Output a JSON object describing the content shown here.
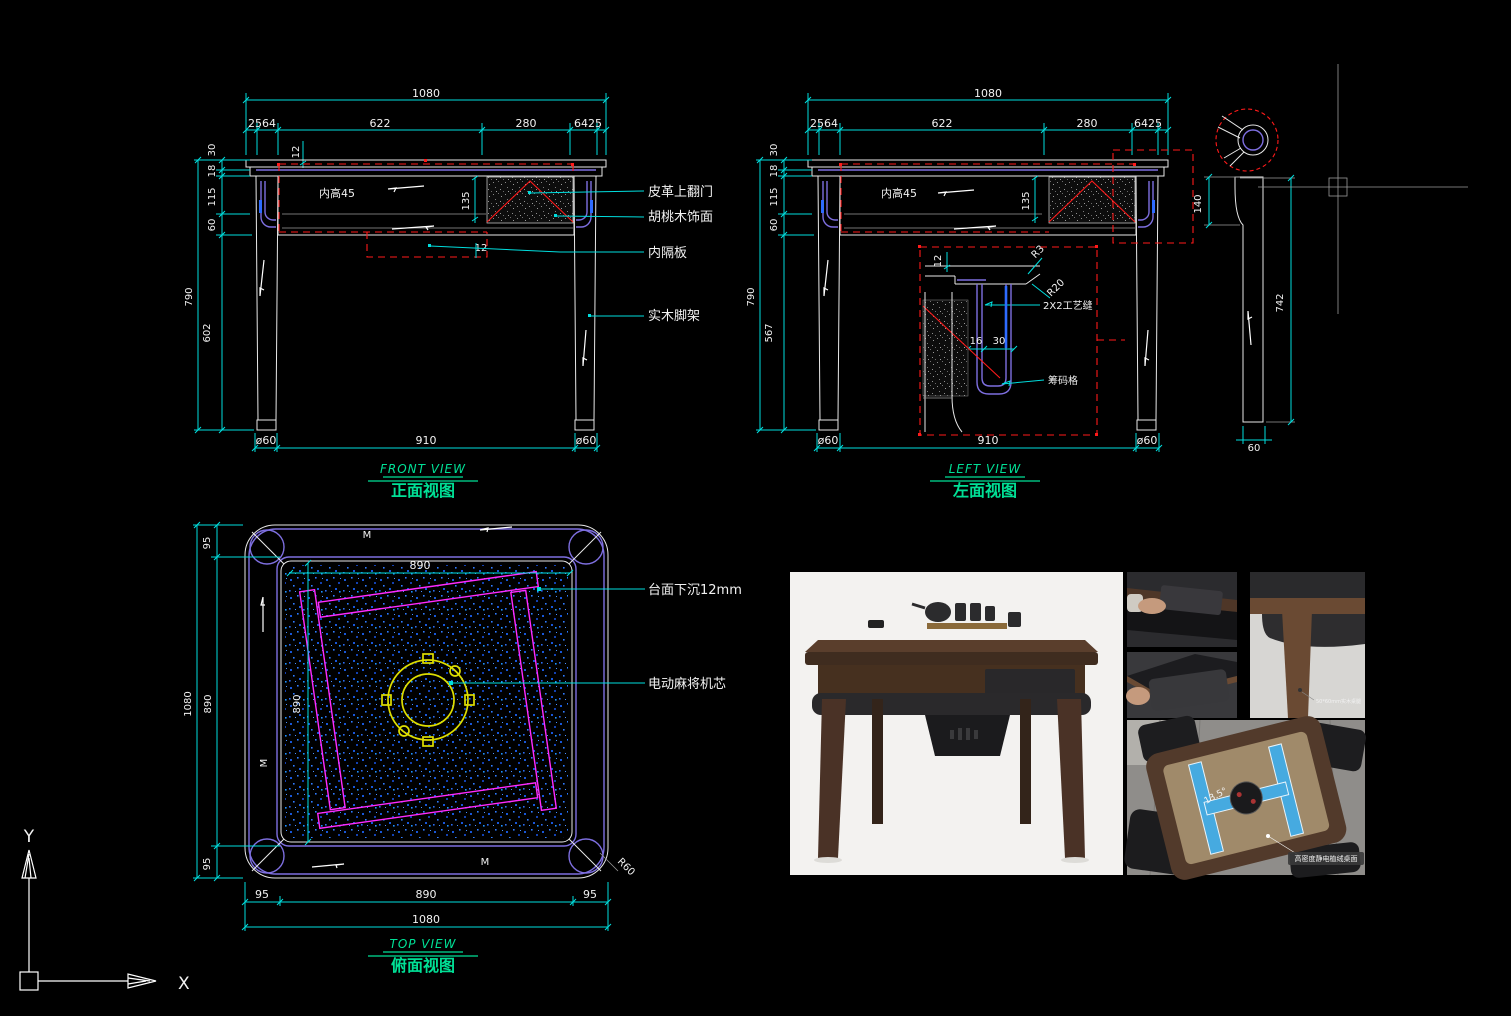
{
  "colors": {
    "background": "#000000",
    "dimension_cyan": "#00dede",
    "line_white": "#e8e8e8",
    "detail_red": "#ff1a1a",
    "frame_purple": "#7e6fe0",
    "rail_magenta": "#ff2bff",
    "core_yellow": "#dede00",
    "speckle_blue": "#1e5fe0",
    "title_green": "#00e096"
  },
  "front_view": {
    "title_en": "FRONT VIEW",
    "title_cn": "正面视图",
    "dims": {
      "total_w": "1080",
      "segs": [
        "2564",
        "622",
        "280",
        "6425"
      ],
      "top_offset": "12",
      "inner_note": "内高45",
      "door_h": "135",
      "bottom_panel": "12",
      "stack": [
        "30",
        "18",
        "115",
        "60"
      ],
      "leg_h": "602",
      "total_h": "790",
      "leg_dia": "ø60",
      "leg_span": "910"
    },
    "callouts": [
      "皮革上翻门",
      "胡桃木饰面",
      "内隔板",
      "实木脚架"
    ]
  },
  "left_view": {
    "title_en": "LEFT VIEW",
    "title_cn": "左面视图",
    "dims": {
      "total_w": "1080",
      "segs": [
        "2564",
        "622",
        "280",
        "6425"
      ],
      "inner_note": "内高45",
      "door_h": "135",
      "stack": [
        "30",
        "18",
        "115",
        "60"
      ],
      "leg_h": "567",
      "total_h": "790",
      "leg_dia": "ø60",
      "leg_span": "910"
    },
    "detail": {
      "top_offset": "12",
      "r3": "R3",
      "r20": "R20",
      "seam": "2X2工艺缝",
      "d16": "16",
      "d30": "30",
      "slot": "筹码格"
    }
  },
  "leg_detail": {
    "top_w": "140",
    "height": "742",
    "bottom_w": "60"
  },
  "top_view": {
    "title_en": "TOP VIEW",
    "title_cn": "俯面视图",
    "dims": {
      "margin": "95",
      "inner": "890",
      "total": "1080",
      "corner_r": "R60"
    },
    "callouts": [
      "台面下沉12mm",
      "电动麻将机芯"
    ],
    "mark": "M"
  },
  "photos": {
    "leg_note": "50*60mm实木桌腿",
    "angle_note": "13.5°",
    "surface_note": "高密度静电植绒桌面"
  },
  "ucs": {
    "x": "X",
    "y": "Y"
  }
}
